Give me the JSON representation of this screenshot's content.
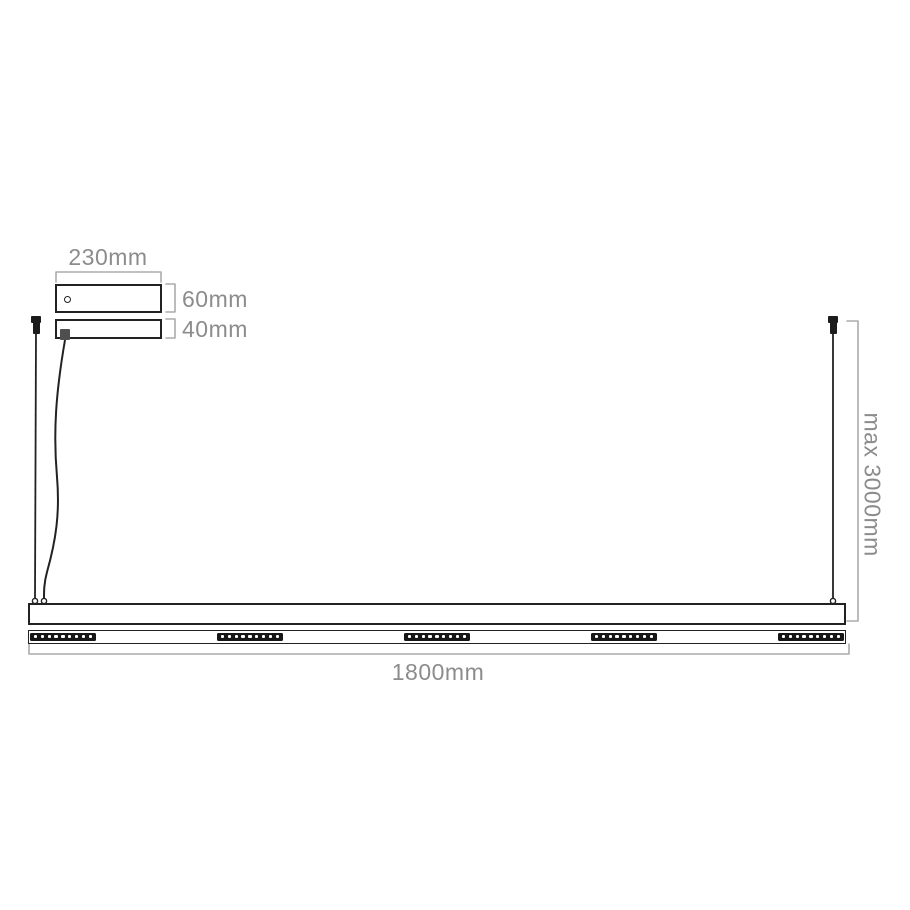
{
  "meta": {
    "title": "Linear pendant light fixture — dimension drawing"
  },
  "labels": {
    "canopy_width": "230mm",
    "canopy_height": "60mm",
    "plate_height": "40mm",
    "suspension_max": "max 3000mm",
    "fixture_length": "1800mm"
  },
  "led": {
    "segments": 5,
    "dots_per_segment": 9
  },
  "colors": {
    "outline": "#222222",
    "dimension_line": "#ababab",
    "dimension_text": "#8c8c8c",
    "led_block": "#161616",
    "background": "#ffffff"
  }
}
